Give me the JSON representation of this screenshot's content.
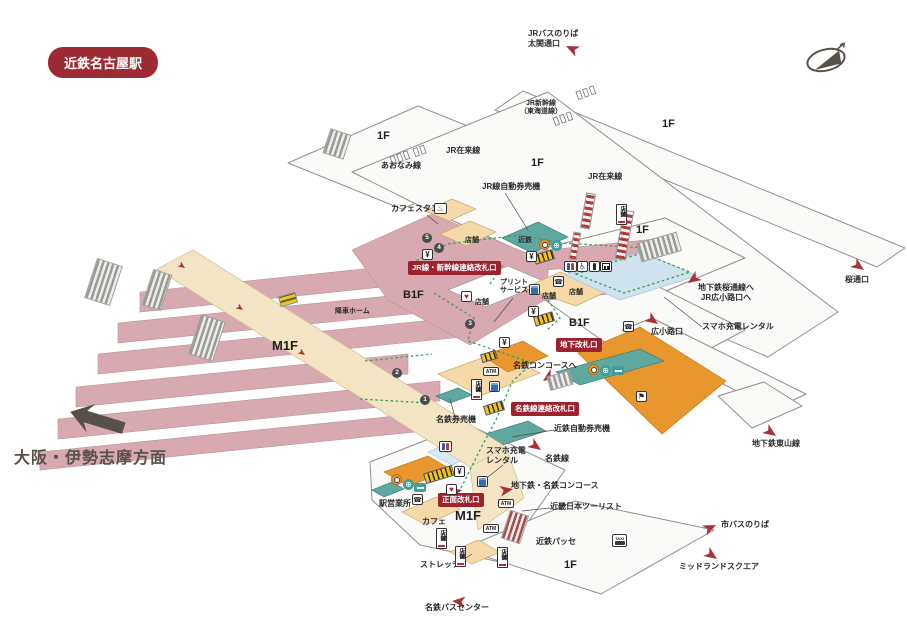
{
  "station_badge": "近鉄名古屋駅",
  "direction": "大阪・伊勢志摩方面",
  "floors": {
    "f1": "1F",
    "b1f": "B1F",
    "m1f": "M1F"
  },
  "platform_nums": {
    "n1": "1",
    "n2": "2",
    "n3": "3",
    "n4": "4",
    "n5": "5"
  },
  "gates": {
    "jr_transfer": "JR線・新幹線連絡改札口",
    "underground": "地下改札口",
    "meitetsu_transfer": "名鉄線連絡改札口",
    "main": "正面改札口"
  },
  "lines": {
    "jr_local": "JR在来線",
    "aonami": "あおなみ線",
    "shinkansen_l1": "JR新幹線",
    "shinkansen_l2": "（東海道線）",
    "meitetsu_line": "名鉄線",
    "higashiyama": "地下鉄東山線"
  },
  "areas": {
    "alight_platform": "降車ホーム",
    "shop": "店舗",
    "kintetsu": "近鉄",
    "passe": "近鉄パッセ",
    "cafe": "カフェ",
    "office": "駅営業所",
    "stretch": "ストレッチ",
    "tourist": "近畿日本ツーリスト"
  },
  "machines": {
    "jr_tvm": "JR線自動券売機",
    "kintetsu_tvm": "近鉄自動券売機",
    "meitetsu_tvm": "名鉄券売機",
    "atm": "ATM",
    "yen": "¥",
    "taxi": "TAXI"
  },
  "services": {
    "cafe_stand": "カフェスタンド",
    "print_l1": "プリント",
    "print_l2": "サービス",
    "charge": "スマホ充電レンタル",
    "charge_l1": "スマホ充電",
    "charge_l2": "レンタル"
  },
  "wayfinding": {
    "jr_bus_l1": "JRバスのりば",
    "jr_bus_l2": "太閤通口",
    "sakura_route_l1": "地下鉄桜通線へ",
    "sakura_route_l2": "JR広小路口へ",
    "sakura_exit": "桜通口",
    "hirokoji_exit": "広小路口",
    "meitetsu_concourse": "名鉄コンコースへ",
    "chika_meitetsu": "地下鉄・名鉄コンコース",
    "city_bus": "市バスのりば",
    "midland": "ミッドランドスクエア",
    "meitetsu_bus": "名鉄バスセンター"
  },
  "icon_glyphs": {
    "phone": "☎",
    "heart": "♥",
    "flag": "⚑",
    "wheelchair": "♿",
    "globe": "⊕",
    "cafe_stand": "♨"
  },
  "colors": {
    "accent_red": "#9d2b33",
    "platform_pink": "#d9a9b2",
    "walkway_beige": "#f3e5c3",
    "shop_tan": "#f5d9a8",
    "counter_teal": "#5fa89f",
    "highlight_orange": "#e8962e",
    "route_green": "#2fa357",
    "pond_blue": "#cfe3ef",
    "arrow_red": "#a93238",
    "dark_gray": "#57514a"
  }
}
